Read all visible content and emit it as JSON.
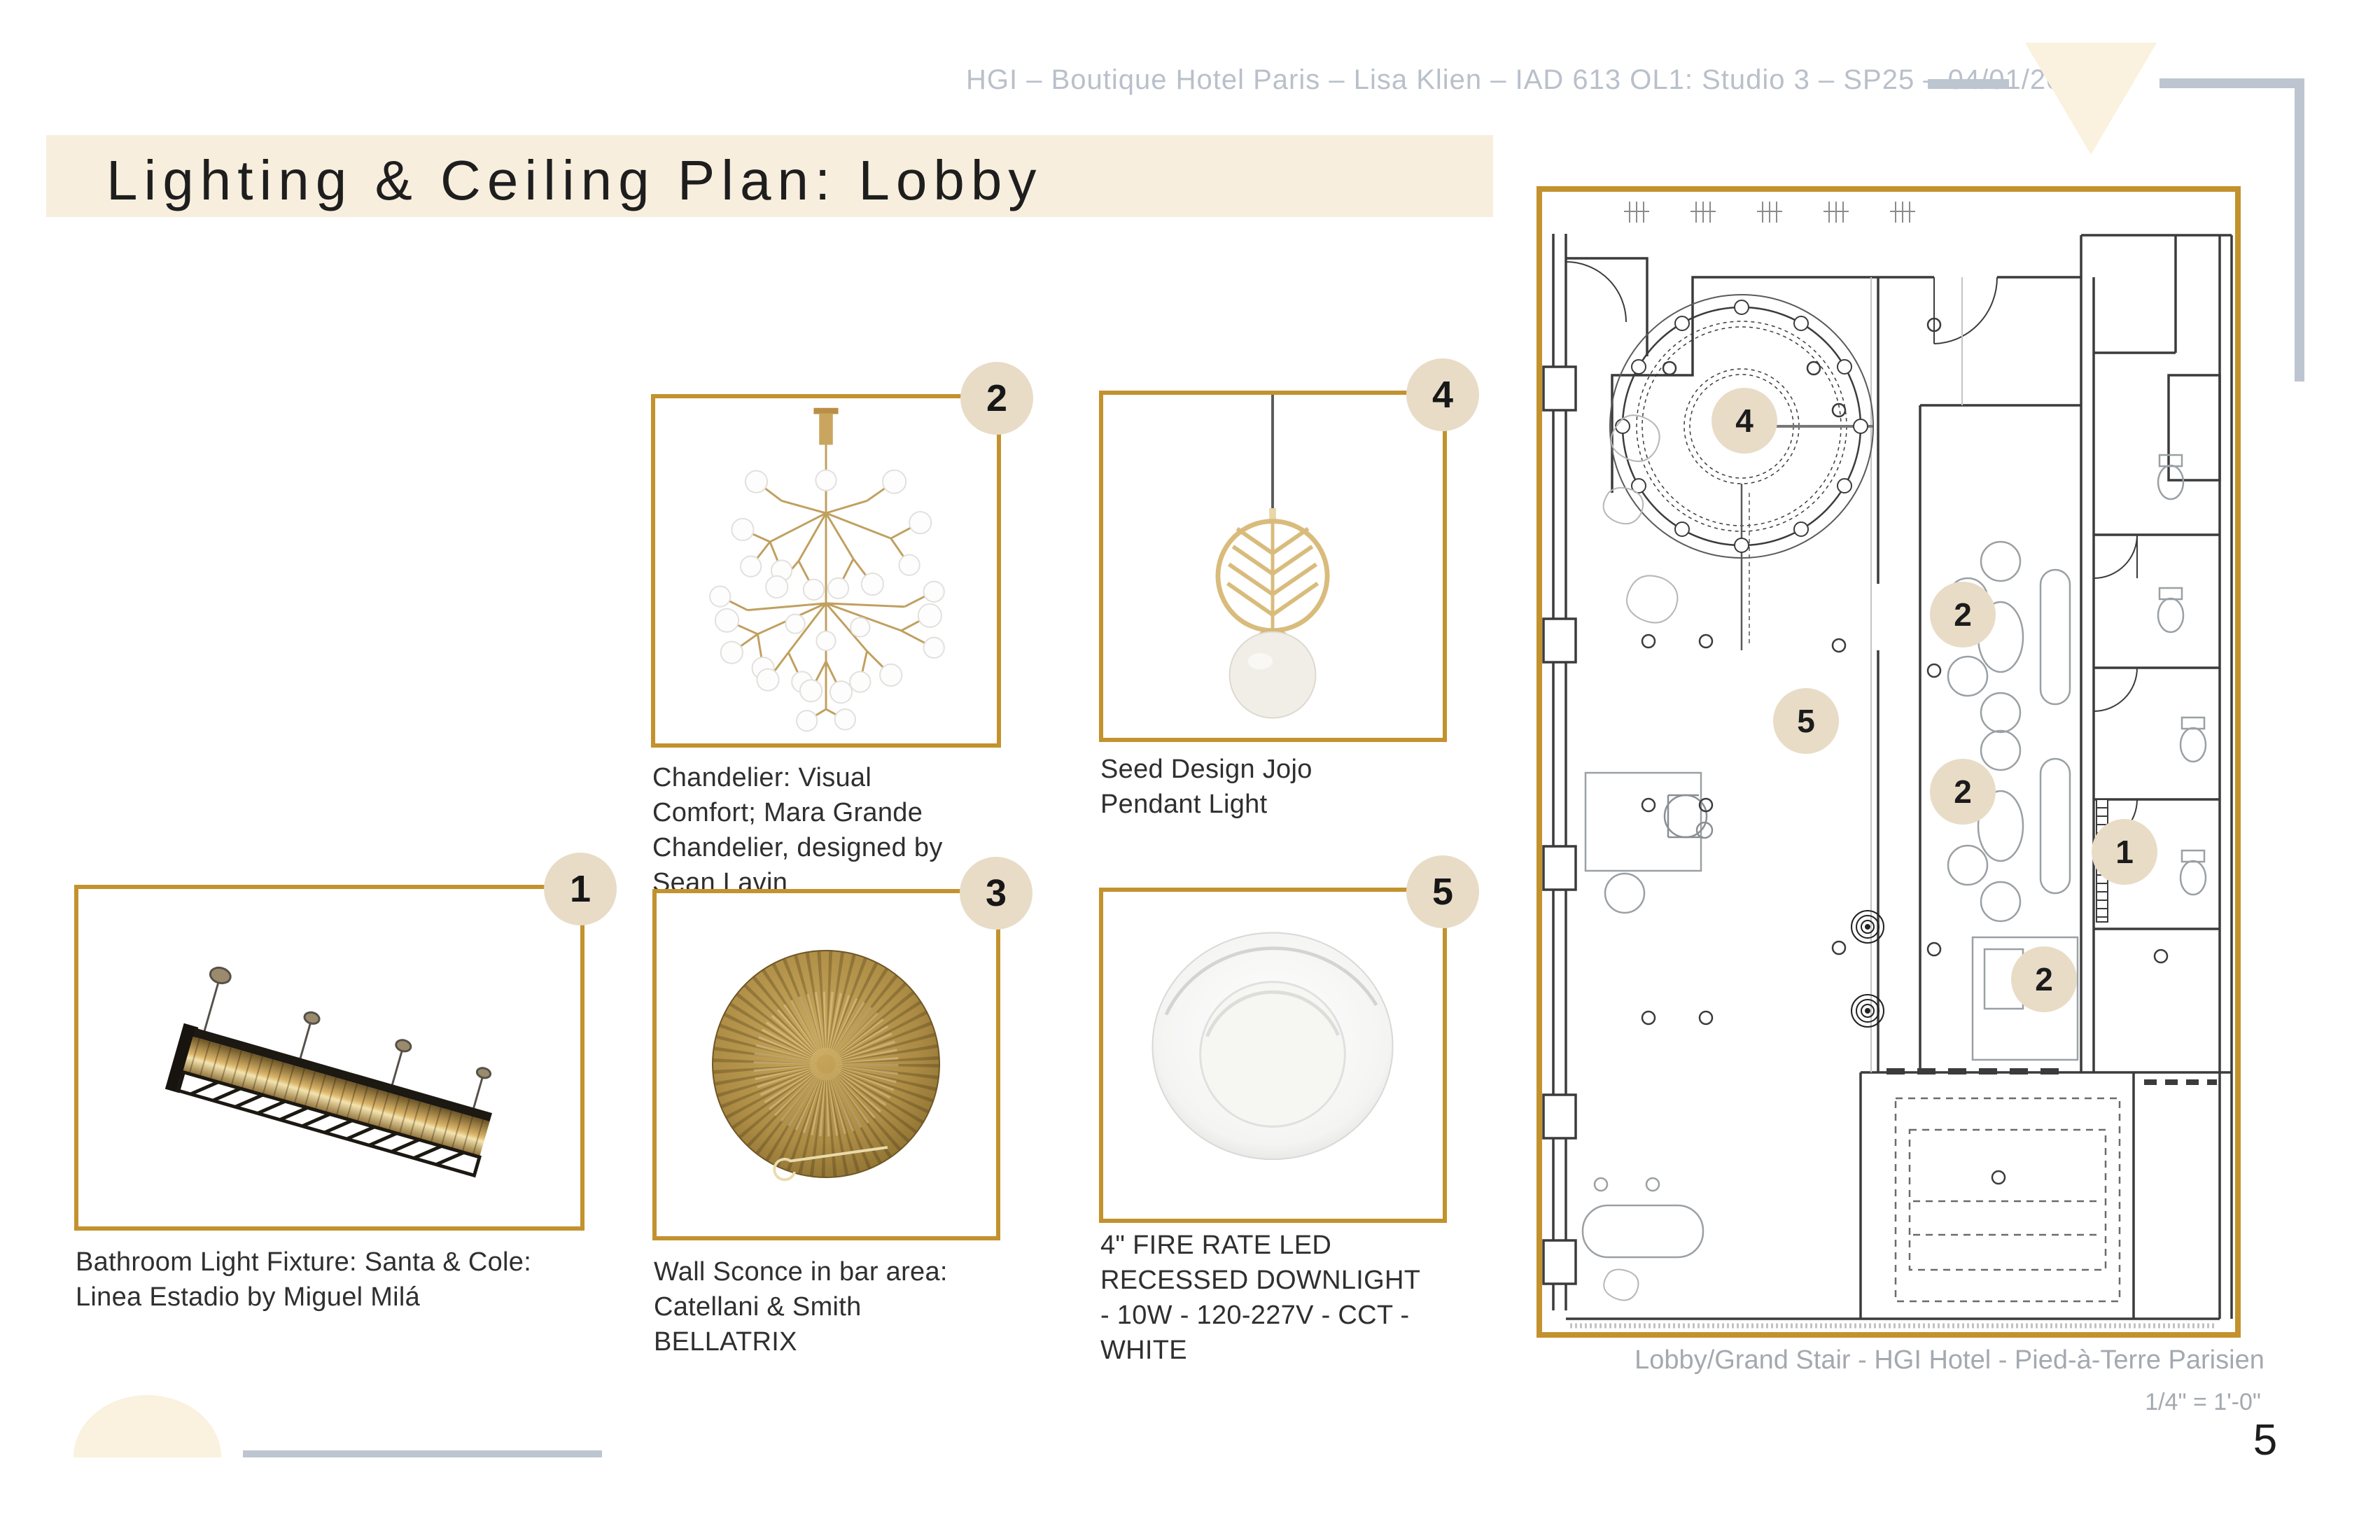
{
  "header": {
    "project_line": "HGI – Boutique Hotel Paris – Lisa Klien – IAD 613 OL1: Studio 3 – SP25 – 04/01/2025"
  },
  "title": "Lighting & Ceiling Plan: Lobby",
  "fixtures": [
    {
      "number": "1",
      "caption": "Bathroom Light Fixture: Santa & Cole: Linea Estadio by Miguel Milá"
    },
    {
      "number": "2",
      "caption": "Chandelier: Visual Comfort; Mara Grande Chandelier, designed by Sean Lavin"
    },
    {
      "number": "3",
      "caption": "Wall Sconce in bar area: Catellani & Smith BELLATRIX"
    },
    {
      "number": "4",
      "caption": "Seed Design Jojo Pendant Light"
    },
    {
      "number": "5",
      "caption": "4\" FIRE RATE LED RECESSED DOWNLIGHT - 10W - 120-227V - CCT - WHITE"
    }
  ],
  "plan": {
    "caption": "Lobby/Grand Stair - HGI Hotel - Pied-à-Terre Parisien",
    "scale": "1/4\" = 1'-0\"",
    "badges": [
      {
        "label": "4"
      },
      {
        "label": "2"
      },
      {
        "label": "5"
      },
      {
        "label": "2"
      },
      {
        "label": "1"
      },
      {
        "label": "2"
      }
    ]
  },
  "page_number": "5",
  "colors": {
    "accent_gold": "#c3922e",
    "badge_beige": "#e8dcc7",
    "cream": "#f7eedd",
    "line_gray": "#bcc5d0"
  }
}
